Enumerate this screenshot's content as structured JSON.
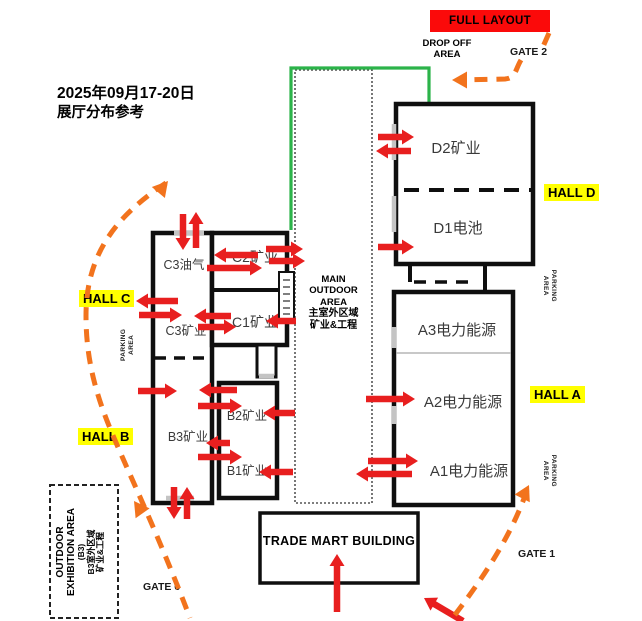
{
  "meta": {
    "title_line1": "2025年09月17-20日",
    "title_line2": "展厅分布参考"
  },
  "banner": {
    "label": "FULL LAYOUT"
  },
  "labels": {
    "drop_off_line1": "DROP OFF",
    "drop_off_line2": "AREA",
    "gate1": "GATE 1",
    "gate2": "GATE 2",
    "gate6": "GATE 6",
    "parking_line1": "PARKING",
    "parking_line2": "AREA"
  },
  "hall_badges": {
    "d": "HALL D",
    "c": "HALL C",
    "a": "HALL A",
    "b": "HALL B"
  },
  "zones": {
    "d2": "D2矿业",
    "d1": "D1电池",
    "a3": "A3电力能源",
    "a2": "A2电力能源",
    "a1": "A1电力能源",
    "c3_oil": "C3油气",
    "c3_mining": "C3矿业",
    "c2": "C2矿业",
    "c1": "C1矿业",
    "b3": "B3矿业",
    "b2": "B2矿业",
    "b1": "B1矿业"
  },
  "main_outdoor": {
    "l1": "MAIN",
    "l2": "OUTDOOR",
    "l3": "AREA",
    "l4": "主室外区域",
    "l5": "矿业&工程"
  },
  "outdoor_exhibition": {
    "l1": "OUTDOOR",
    "l2": "EXHIBITION AREA",
    "l3": "(B3)",
    "l4": "B3室外区域",
    "l5": "矿业&工程"
  },
  "trade_mart": {
    "label": "TRADE MART BUILDING"
  },
  "colors": {
    "arrow_red": "#e81f1f",
    "route_orange": "#f2731d",
    "banner_red": "#fb0a0a",
    "badge_yellow": "#ffff00",
    "path_green": "#2cb34a",
    "wall_black": "#0f0f0f"
  },
  "map": {
    "red_arrows": [
      [
        183,
        214,
        183,
        250
      ],
      [
        196,
        248,
        196,
        212
      ],
      [
        258,
        255,
        214,
        255
      ],
      [
        207,
        268,
        262,
        268
      ],
      [
        266,
        249,
        303,
        249
      ],
      [
        269,
        261,
        305,
        261
      ],
      [
        178,
        301,
        136,
        301
      ],
      [
        139,
        315,
        182,
        315
      ],
      [
        231,
        316,
        194,
        316
      ],
      [
        198,
        327,
        236,
        327
      ],
      [
        296,
        321,
        266,
        321
      ],
      [
        378,
        137,
        414,
        137
      ],
      [
        411,
        151,
        376,
        151
      ],
      [
        378,
        247,
        414,
        247
      ],
      [
        366,
        399,
        415,
        399
      ],
      [
        368,
        461,
        418,
        461
      ],
      [
        412,
        474,
        356,
        474
      ],
      [
        138,
        391,
        177,
        391
      ],
      [
        237,
        390,
        199,
        390
      ],
      [
        198,
        406,
        242,
        406
      ],
      [
        295,
        413,
        263,
        413
      ],
      [
        230,
        443,
        206,
        443
      ],
      [
        198,
        457,
        242,
        457
      ],
      [
        293,
        472,
        259,
        472
      ],
      [
        174,
        487,
        174,
        519
      ],
      [
        187,
        519,
        187,
        487
      ],
      [
        337,
        612,
        337,
        554
      ],
      [
        463,
        621,
        424,
        598
      ]
    ],
    "orange_routes": [
      {
        "d": "M549,33 L542,49",
        "head": null
      },
      {
        "d": "M521,60 C515,70 516,78 505,79 L460,80",
        "head": [
          452,
          80,
          180
        ]
      },
      {
        "d": "M166,183 C116,216 86,254 86,316 C86,380 108,424 128,470 C145,508 168,560 190,618",
        "head": [
          168,
          181,
          -50
        ]
      },
      {
        "d": "",
        "head": [
          134,
          501,
          -125
        ]
      },
      {
        "d": "M527,490 C512,535 483,578 454,616",
        "head": [
          529,
          485,
          -63
        ]
      }
    ]
  }
}
